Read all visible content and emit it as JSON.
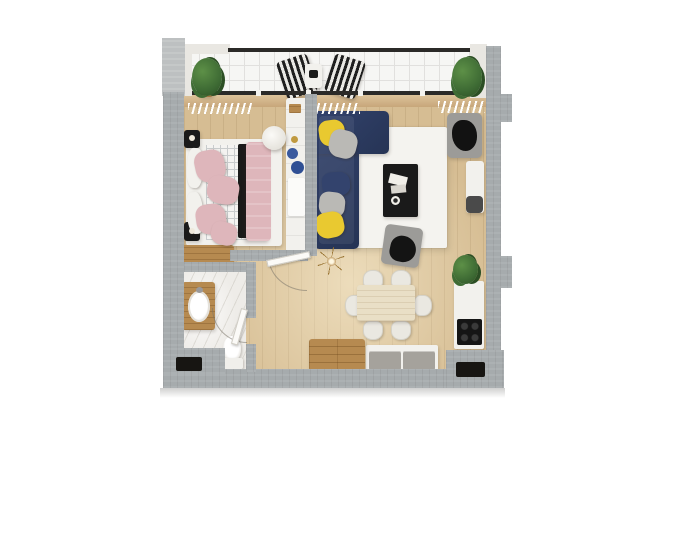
{
  "meta": {
    "kind": "3d-apartment-floor-plan-top-view",
    "canvas": {
      "width": 700,
      "height": 533
    },
    "background": "#ffffff"
  },
  "palette": {
    "wall": "#a6abad",
    "wall-light": "#bdc0c1",
    "parapet": "#e9e7e2",
    "railing": "#2b2a28",
    "floor-wood": "#d6bd93",
    "balcony-floor": "#f6f6f4",
    "balcony-grid": "#e1e0de",
    "marble": "#eeece8",
    "sill": "#c7a67a",
    "sill-light": "#ddc39a",
    "white-furn": "#f2f1ed",
    "black-furn": "#1a1a1a",
    "gray-furn": "#9c9b98",
    "graypil": "#bab9b5",
    "navy": "#263455",
    "navy-light": "#33436d",
    "yellow": "#e9c930",
    "pink": "#deb6bb",
    "wood-furn": "#b68a50",
    "rug": "#f4f3ef",
    "green": "#3e6b34",
    "green-light": "#5d9047",
    "green-dark": "#2c4f24",
    "chair-cream": "#eae8e1",
    "table-cream": "#e9dfc6",
    "cooktop": "#151515",
    "cabinet-gray": "#a5a29c",
    "checker": "#c9cccd",
    "niche": "#171512"
  },
  "rooms": [
    {
      "id": "balcony",
      "name": "balcony",
      "furniture": [
        "striped-lounge-chair-left",
        "striped-lounge-chair-right",
        "balcony-side-table",
        "potted-plant-left",
        "potted-plant-right",
        "glass-railing"
      ]
    },
    {
      "id": "bedroom",
      "name": "bedroom",
      "furniture": [
        "double-bed",
        "pink-pillows-x4",
        "white-pillows-x2",
        "black-throw-blanket",
        "pink-duvet",
        "nightstand-top",
        "nightstand-bottom",
        "wooden-dresser",
        "vanity-desk",
        "round-stool",
        "clothes-hanger-rail"
      ]
    },
    {
      "id": "living-room",
      "name": "living-room",
      "furniture": [
        "navy-corner-sofa",
        "yellow-cushion-x2",
        "gray-cushion-x2",
        "navy-cushion",
        "white-area-rug",
        "black-coffee-table",
        "magazines",
        "decor-bowl",
        "gray-armchair-by-window",
        "gray-armchair-center",
        "wall-desk",
        "desk-chair",
        "ceiling-lamp",
        "potted-plant"
      ]
    },
    {
      "id": "dining-area",
      "name": "dining-area",
      "furniture": [
        "wooden-dining-table",
        "dining-chair-x6"
      ]
    },
    {
      "id": "kitchen",
      "name": "kitchen",
      "furniture": [
        "kitchen-counter",
        "cooktop-4-burners",
        "gray-base-cabinets",
        "wooden-sideboard-chest"
      ]
    },
    {
      "id": "bathroom",
      "name": "bathroom",
      "furniture": [
        "wooden-vanity",
        "oval-sink",
        "toilet",
        "door-swing-arc"
      ]
    },
    {
      "id": "hallway",
      "name": "hallway",
      "furniture": [
        "bedroom-door-leaf"
      ]
    }
  ],
  "architecture": {
    "walls": "cast-concrete-gray-perimeter-with-piers",
    "windows": "full-width-glazing-between-balcony-and-interior",
    "radiator_hatches": 3,
    "entrance_niches": 2
  }
}
